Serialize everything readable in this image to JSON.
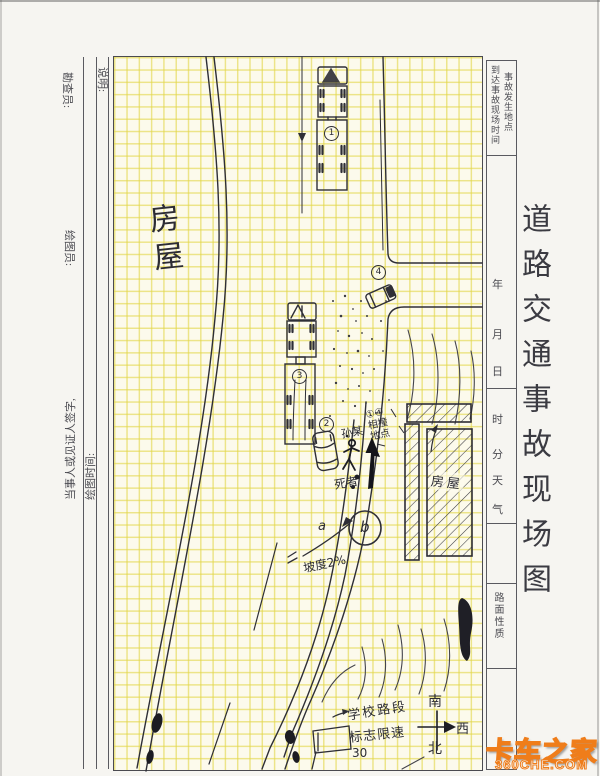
{
  "form": {
    "title": "道路交通事故现场图",
    "left": {
      "surveyor": "勘查员:",
      "drawer": "绘图员:",
      "note": "说明:",
      "draw_time": "绘图时间:",
      "party_sign": "当事人或见证人签字,"
    },
    "right": {
      "arrival_time": "到达事故现场时间",
      "accident_place": "事故发生地点",
      "year": "年",
      "month": "月",
      "day": "日",
      "hour": "时",
      "minute": "分",
      "weather1": "天",
      "weather2": "气",
      "road_surface": "路面性质"
    }
  },
  "sketch": {
    "house_left": "房屋",
    "house_right": "房屋",
    "victim_name": "孙某",
    "deceased": "死者",
    "collision": {
      "l1": "①④",
      "l2": "相撞",
      "l3": "地点"
    },
    "slope": "坡度2%",
    "point_a": "a",
    "point_b": "b",
    "school": {
      "l1": "学校路段",
      "l2": "标志限速",
      "l3": "30"
    },
    "compass": {
      "south": "南",
      "west": "西",
      "north": "北"
    },
    "marks": {
      "m1": "1",
      "m2": "2",
      "m3": "3",
      "m4": "4"
    }
  },
  "watermark": {
    "brand": "卡车之家",
    "site": "360CHE.COM"
  }
}
